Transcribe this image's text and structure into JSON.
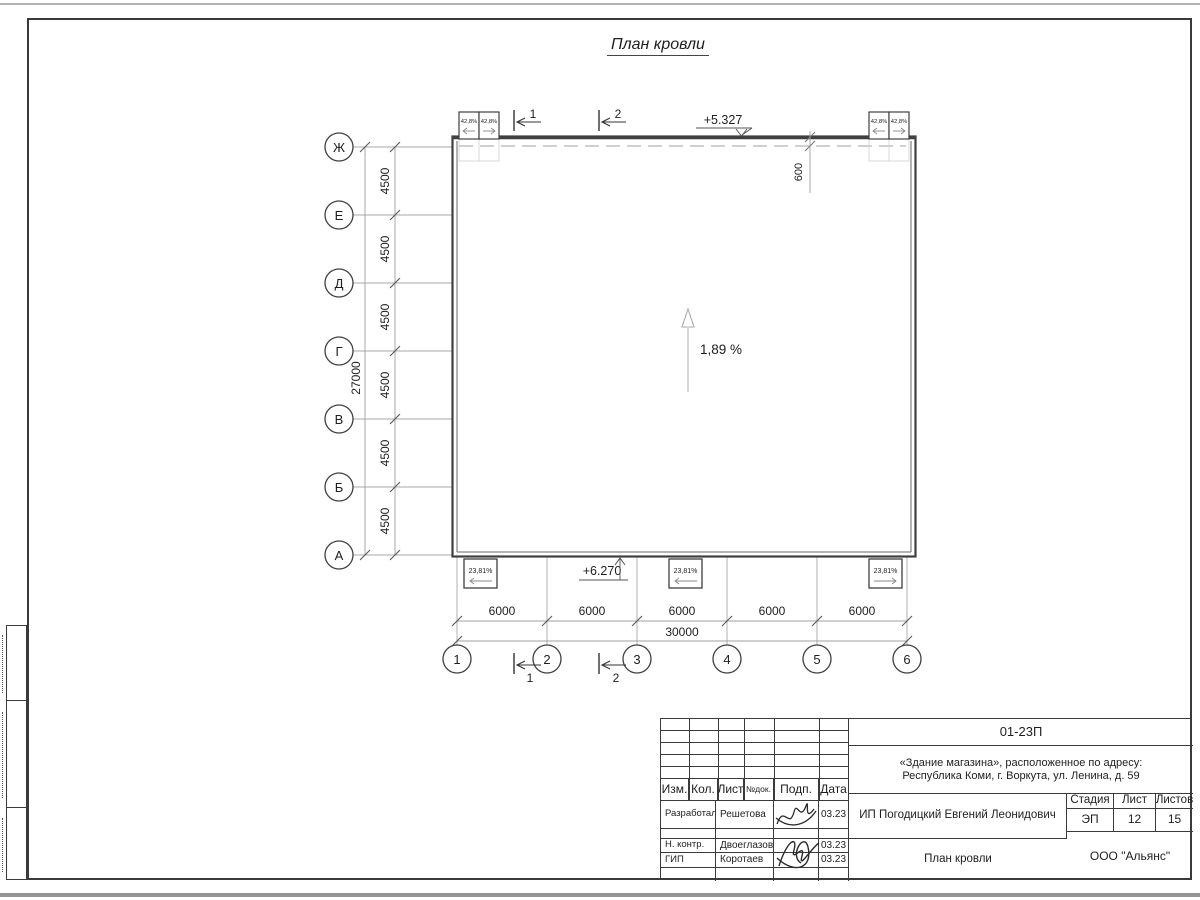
{
  "page": {
    "title": "План кровли"
  },
  "plan": {
    "row_axes": [
      "Ж",
      "Е",
      "Д",
      "Г",
      "В",
      "Б",
      "А"
    ],
    "col_axes": [
      "1",
      "2",
      "3",
      "4",
      "5",
      "6"
    ],
    "row_dim": "4500",
    "row_total": "27000",
    "col_dim": "6000",
    "col_total": "30000",
    "parapet_dim": "600",
    "elev_top": "+5.327",
    "elev_bottom": "+6.270",
    "slope": "1,89 %",
    "funnel_top": "42,8%",
    "funnel_bottom": "23,81%",
    "section_1": "1",
    "section_2": "2"
  },
  "titleblock": {
    "doc_number": "01-23П",
    "object_line1": "«Здание магазина», расположенное по адресу:",
    "object_line2": "Республика Коми, г. Воркута, ул. Ленина, д. 59",
    "headers": {
      "izm": "Изм.",
      "kol": "Кол.",
      "list": "Лист",
      "ndok": "№док.",
      "podp": "Подп.",
      "data": "Дата"
    },
    "rows": [
      {
        "role": "Разработал",
        "name": "Решетова",
        "date": "03.23"
      },
      {
        "role": "Н. контр.",
        "name": "Двоеглазов",
        "date": "03.23"
      },
      {
        "role": "ГИП",
        "name": "Коротаев",
        "date": "03.23"
      }
    ],
    "client": "ИП Погодицкий Евгений Леонидович",
    "stage_header": "Стадия",
    "sheet_header": "Лист",
    "sheets_header": "Листов",
    "stage": "ЭП",
    "sheet": "12",
    "sheets": "15",
    "sheet_title": "План кровли",
    "company": "ООО \"Альянс\""
  }
}
